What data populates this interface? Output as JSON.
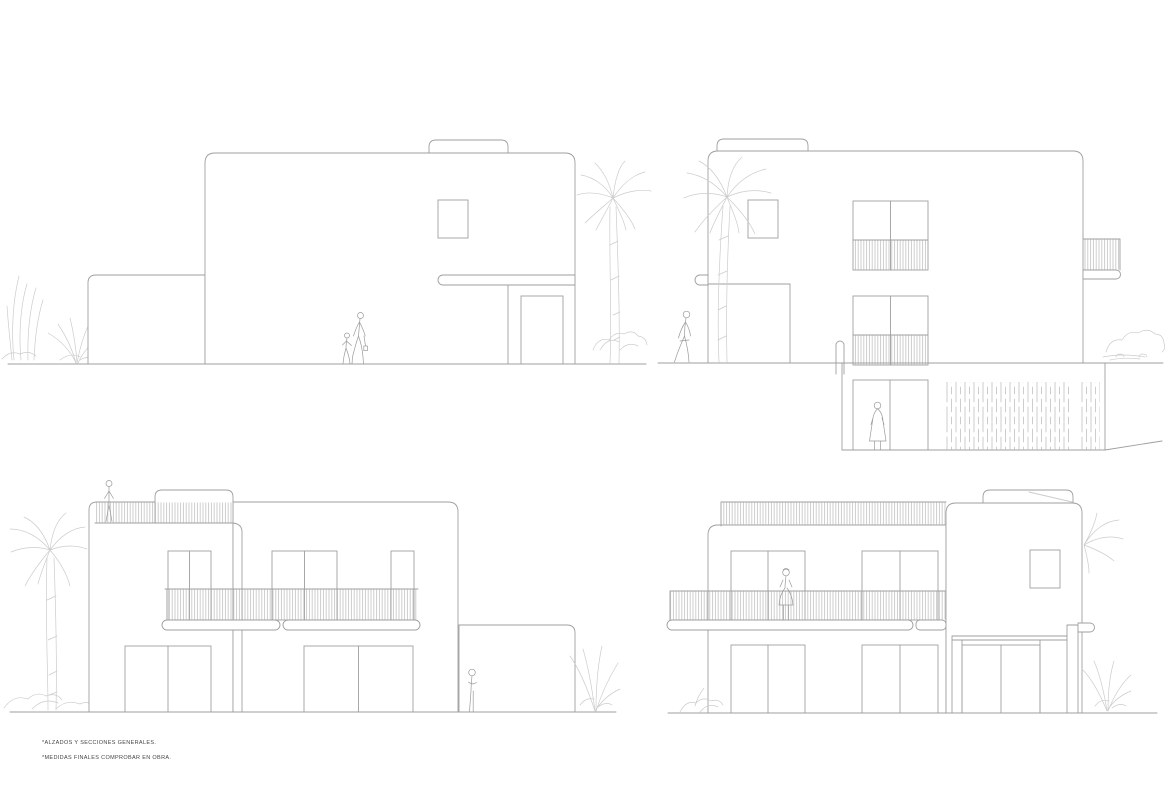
{
  "canvas": {
    "width": 1170,
    "height": 785,
    "background": "#ffffff"
  },
  "palette": {
    "line": "#9f9f9f",
    "light_line": "#cccccc",
    "figure": "#9a9a9a",
    "text": "#454545",
    "wall_fill": "#ffffff"
  },
  "footnotes": {
    "line1": "*ALZADOS Y SECCIONES GENERALES.",
    "line2": "*MEDIDAS FINALES COMPROBAR EN OBRA."
  },
  "elevations": [
    {
      "id": "top-left",
      "description": "side elevation with low wing, rooftop volume, entry canopy and door"
    },
    {
      "id": "top-right",
      "description": "side elevation with balconies, sunken garage level and palm"
    },
    {
      "id": "bottom-left",
      "description": "front elevation with roof terrace railing, long balcony and side wing"
    },
    {
      "id": "bottom-right",
      "description": "rear elevation with long balcony, garage tower and palms"
    }
  ]
}
